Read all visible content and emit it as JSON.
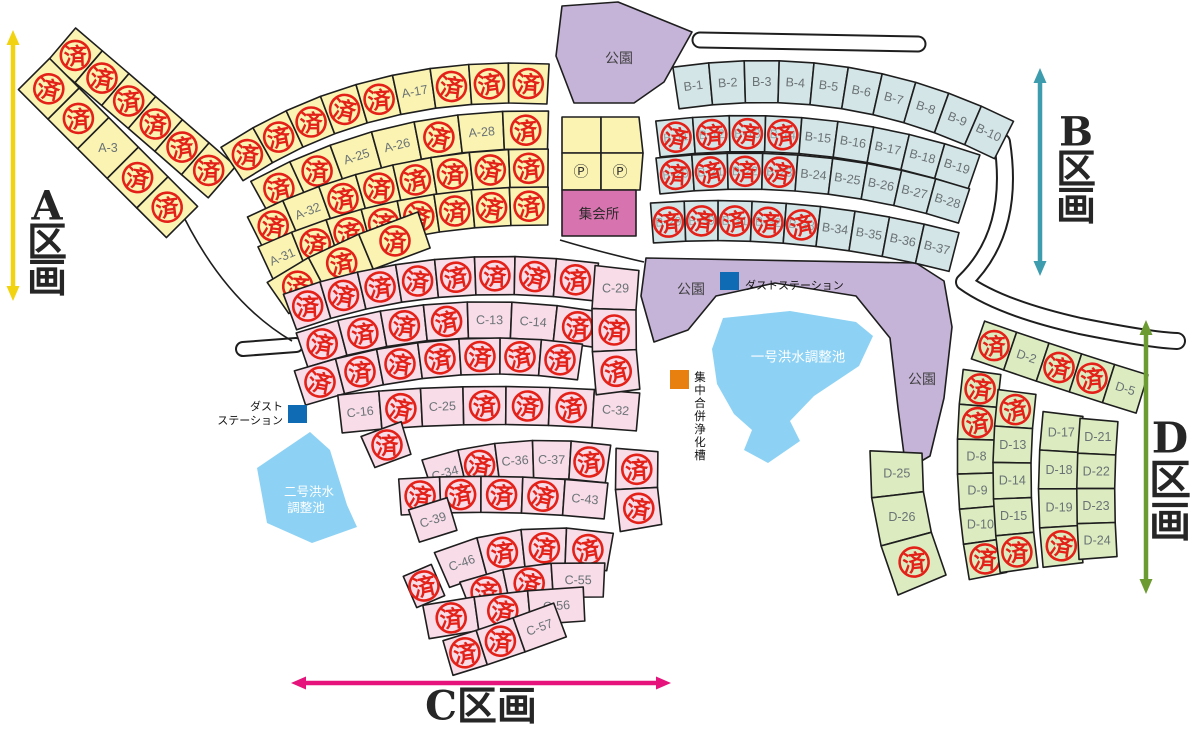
{
  "canvas": {
    "w": 1199,
    "h": 731,
    "bg": "#ffffff",
    "outline": "#1e1e1e"
  },
  "stamp": {
    "char": "済",
    "color": "#e32119",
    "meaning": "sold"
  },
  "lot_label_color": "#6a7275",
  "faint_label_color": "#9aa5a5",
  "sections": [
    {
      "id": "A",
      "label": "A区画",
      "chars": [
        "A",
        "区",
        "画"
      ],
      "arrow_color": "#f2d311",
      "lot_fill": "#faf3b2",
      "arrow": {
        "x1": 13,
        "y1": 30,
        "x2": 13,
        "y2": 301
      },
      "label_x": 47,
      "label_y": 206,
      "label_dy": 36,
      "font": 40,
      "vertical": true
    },
    {
      "id": "B",
      "label": "B区画",
      "chars": [
        "B",
        "区",
        "画"
      ],
      "arrow_color": "#3d9cad",
      "lot_fill": "#d4e5e7",
      "arrow": {
        "x1": 1040,
        "y1": 68,
        "x2": 1040,
        "y2": 276
      },
      "label_x": 1076,
      "label_y": 132,
      "label_dy": 37,
      "font": 40,
      "vertical": true
    },
    {
      "id": "C",
      "label": "C区画",
      "chars": [
        "C",
        "区",
        "画"
      ],
      "arrow_color": "#e5137b",
      "lot_fill": "#f8dce8",
      "arrow": {
        "x1": 291,
        "y1": 683,
        "x2": 671,
        "y2": 683
      },
      "label_x": 481,
      "label_y": 706,
      "font": 40,
      "vertical": false
    },
    {
      "id": "D",
      "label": "D区画",
      "chars": [
        "D",
        "区",
        "画"
      ],
      "arrow_color": "#6c9b31",
      "lot_fill": "#dcecc0",
      "arrow": {
        "x1": 1146,
        "y1": 320,
        "x2": 1146,
        "y2": 594
      },
      "label_x": 1170,
      "label_y": 438,
      "label_dy": 42,
      "font": 42,
      "vertical": true
    }
  ],
  "rows": [
    {
      "sec": "A",
      "p0": [
        62,
        44
      ],
      "c": [
        142,
        112
      ],
      "p2": [
        222,
        182
      ],
      "d": 42,
      "lots": [
        "*",
        "*",
        "*",
        "*",
        "*",
        "*"
      ]
    },
    {
      "sec": "A",
      "p0": [
        34,
        74
      ],
      "c": [
        108,
        148
      ],
      "p2": [
        182,
        222
      ],
      "d": 44,
      "lots": [
        "*",
        "*",
        "A-3",
        "*",
        "*"
      ]
    },
    {
      "sec": "A",
      "p0": [
        232,
        164
      ],
      "c": [
        368,
        74
      ],
      "p2": [
        548,
        84
      ],
      "d": 40,
      "lots": [
        "*",
        "*",
        "*",
        "*",
        "*",
        "A-17",
        "*",
        "*",
        "*"
      ]
    },
    {
      "sec": "A",
      "p0": [
        260,
        198
      ],
      "c": [
        390,
        126
      ],
      "p2": [
        548,
        130
      ],
      "d": 38,
      "lots": [
        "*",
        "*",
        "A-25",
        "A-26",
        "*",
        "A-28",
        "*"
      ]
    },
    {
      "sec": "A",
      "p0": [
        256,
        234
      ],
      "c": [
        392,
        166
      ],
      "p2": [
        548,
        168
      ],
      "d": 38,
      "lots": [
        "*",
        "A-32",
        "*",
        "*",
        "*",
        "*",
        "*",
        "*"
      ]
    },
    {
      "sec": "A",
      "p0": [
        266,
        264
      ],
      "c": [
        395,
        204
      ],
      "p2": [
        548,
        206
      ],
      "d": 38,
      "lots": [
        "A-31",
        "*",
        "*",
        "*",
        "*",
        "*",
        "*",
        "*"
      ]
    },
    {
      "sec": "A",
      "p0": [
        278,
        298
      ],
      "c": [
        330,
        262
      ],
      "p2": [
        424,
        230
      ],
      "d": 38,
      "lots": [
        "*",
        "*",
        "*"
      ]
    },
    {
      "sec": "B",
      "p0": [
        676,
        88
      ],
      "c": [
        850,
        62
      ],
      "p2": [
        1004,
        140
      ],
      "d": 42,
      "lots": [
        "B-1",
        "B-2",
        "B-3",
        "B-4",
        "B-5",
        "B-6",
        "B-7",
        "B-8",
        "B-9",
        "B-10"
      ]
    },
    {
      "sec": "B",
      "p0": [
        658,
        139
      ],
      "c": [
        820,
        119
      ],
      "p2": [
        974,
        172
      ],
      "d": 36,
      "lots": [
        "B-11*",
        "B-12*",
        "B-13*",
        "B-14*",
        "B-15",
        "B-16",
        "B-17",
        "B-18",
        "B-19"
      ]
    },
    {
      "sec": "B",
      "p0": [
        658,
        176
      ],
      "c": [
        816,
        158
      ],
      "p2": [
        964,
        206
      ],
      "d": 36,
      "lots": [
        "B-20*",
        "B-21*",
        "B-22*",
        "B-23*",
        "B-24",
        "B-25",
        "B-26",
        "B-27",
        "B-28"
      ]
    },
    {
      "sec": "B",
      "p0": [
        652,
        223
      ],
      "c": [
        800,
        212
      ],
      "p2": [
        954,
        252
      ],
      "d": 40,
      "lots": [
        "B-29*",
        "B-30*",
        "B-31*",
        "B-32*",
        "B-33*",
        "B-34",
        "B-35",
        "B-36",
        "B-37"
      ]
    },
    {
      "sec": "C",
      "p0": [
        290,
        312
      ],
      "c": [
        430,
        260
      ],
      "p2": [
        596,
        282
      ],
      "d": 38,
      "lots": [
        "*",
        "*",
        "*",
        "*",
        "*",
        "*",
        "*",
        "*"
      ]
    },
    {
      "sec": "C",
      "p0": [
        302,
        350
      ],
      "c": [
        442,
        302
      ],
      "p2": [
        600,
        330
      ],
      "d": 36,
      "lots": [
        "*",
        "*",
        "*",
        "*",
        "C-13",
        "C-14",
        "*"
      ]
    },
    {
      "sec": "C",
      "p0": [
        300,
        388
      ],
      "c": [
        440,
        342
      ],
      "p2": [
        580,
        362
      ],
      "d": 36,
      "lots": [
        "*",
        "*",
        "*",
        "*",
        "*",
        "*",
        "*"
      ]
    },
    {
      "sec": "C",
      "p0": [
        340,
        414
      ],
      "c": [
        480,
        398
      ],
      "p2": [
        638,
        412
      ],
      "d": 38,
      "lots": [
        "C-16",
        "*",
        "C-25",
        "*",
        "*",
        "*",
        "C-32"
      ]
    },
    {
      "sec": "C",
      "p0": [
        617,
        268
      ],
      "c": [
        610,
        330
      ],
      "p2": [
        618,
        392
      ],
      "d": 44,
      "lots": [
        "C-29",
        "*",
        "*"
      ]
    },
    {
      "sec": "C",
      "p0": [
        368,
        452
      ],
      "c": [
        386,
        444
      ],
      "p2": [
        406,
        438
      ],
      "d": 34,
      "lots": [
        "*"
      ]
    },
    {
      "sec": "C",
      "p0": [
        428,
        478
      ],
      "c": [
        512,
        450
      ],
      "p2": [
        608,
        464
      ],
      "d": 38,
      "lots": [
        "C-34",
        "*",
        "C-36",
        "C-37",
        "*"
      ]
    },
    {
      "sec": "C",
      "p0": [
        400,
        497
      ],
      "c": [
        500,
        490
      ],
      "p2": [
        606,
        501
      ],
      "d": 36,
      "lots": [
        "*",
        "*",
        "*",
        "*",
        "C-43"
      ]
    },
    {
      "sec": "C",
      "p0": [
        414,
        526
      ],
      "c": [
        432,
        520
      ],
      "p2": [
        452,
        514
      ],
      "d": 34,
      "lots": [
        "C-39"
      ]
    },
    {
      "sec": "C",
      "p0": [
        637,
        450
      ],
      "c": [
        634,
        488
      ],
      "p2": [
        641,
        528
      ],
      "d": 42,
      "lots": [
        "*",
        "*"
      ]
    },
    {
      "sec": "C",
      "p0": [
        442,
        570
      ],
      "c": [
        520,
        536
      ],
      "p2": [
        610,
        552
      ],
      "d": 38,
      "lots": [
        "C-46",
        "*",
        "*",
        "*"
      ]
    },
    {
      "sec": "C",
      "p0": [
        466,
        598
      ],
      "c": [
        522,
        576
      ],
      "p2": [
        604,
        580
      ],
      "d": 34,
      "lots": [
        "*",
        "*",
        "C-55"
      ]
    },
    {
      "sec": "C",
      "p0": [
        426,
        622
      ],
      "c": [
        500,
        608
      ],
      "p2": [
        584,
        604
      ],
      "d": 34,
      "lots": [
        "*",
        "*",
        "C-56"
      ]
    },
    {
      "sec": "C",
      "p0": [
        448,
        658
      ],
      "c": [
        496,
        644
      ],
      "p2": [
        560,
        620
      ],
      "d": 36,
      "lots": [
        "*",
        "*",
        "C-57"
      ]
    },
    {
      "sec": "C",
      "p0": [
        410,
        592
      ],
      "c": [
        424,
        586
      ],
      "p2": [
        438,
        580
      ],
      "d": 34,
      "lots": [
        "*"
      ]
    },
    {
      "sec": "D",
      "p0": [
        978,
        340
      ],
      "c": [
        1058,
        368
      ],
      "p2": [
        1142,
        394
      ],
      "d": 40,
      "lots": [
        "*",
        "D-2",
        "*",
        "*",
        "D-5"
      ]
    },
    {
      "sec": "D",
      "p0": [
        982,
        372
      ],
      "c": [
        968,
        473
      ],
      "p2": [
        988,
        576
      ],
      "d": 38,
      "lots": [
        "*",
        "*",
        "D-8",
        "D-9",
        "D-10",
        "*"
      ]
    },
    {
      "sec": "D",
      "p0": [
        1017,
        392
      ],
      "c": [
        1006,
        480
      ],
      "p2": [
        1019,
        570
      ],
      "d": 38,
      "lots": [
        "*",
        "D-13",
        "D-14",
        "D-15",
        "*"
      ]
    },
    {
      "sec": "D",
      "p0": [
        1063,
        414
      ],
      "c": [
        1054,
        488
      ],
      "p2": [
        1063,
        565
      ],
      "d": 40,
      "lots": [
        "D-17",
        "D-18",
        "D-19",
        "*"
      ]
    },
    {
      "sec": "D",
      "p0": [
        1099,
        420
      ],
      "c": [
        1093,
        488
      ],
      "p2": [
        1098,
        558
      ],
      "d": 38,
      "lots": [
        "D-21",
        "D-22",
        "D-23",
        "D-24"
      ]
    },
    {
      "sec": "D",
      "p0": [
        896,
        452
      ],
      "c": [
        893,
        515
      ],
      "p2": [
        922,
        585
      ],
      "d": 52,
      "lots": [
        "D-25",
        "D-26",
        "*"
      ]
    }
  ],
  "areas": [
    {
      "name": "park-top",
      "fill": "#c6b4d8",
      "stroke": true,
      "points": [
        [
          562,
          6
        ],
        [
          618,
          2
        ],
        [
          692,
          32
        ],
        [
          664,
          82
        ],
        [
          634,
          103
        ],
        [
          574,
          103
        ],
        [
          556,
          56
        ]
      ],
      "labels": [
        [
          "公園",
          619,
          58
        ]
      ]
    },
    {
      "name": "park-center",
      "fill": "#c6b4d8",
      "stroke": true,
      "points": [
        [
          646,
          258
        ],
        [
          916,
          263
        ],
        [
          944,
          281
        ],
        [
          952,
          327
        ],
        [
          944,
          398
        ],
        [
          930,
          456
        ],
        [
          906,
          470
        ],
        [
          898,
          408
        ],
        [
          890,
          338
        ],
        [
          856,
          296
        ],
        [
          775,
          283
        ],
        [
          716,
          296
        ],
        [
          688,
          330
        ],
        [
          654,
          342
        ],
        [
          641,
          296
        ]
      ],
      "labels": [
        [
          "公園",
          691,
          289
        ],
        [
          "公園",
          922,
          379
        ]
      ]
    },
    {
      "name": "pond-1",
      "fill": "#8dd2f4",
      "stroke": false,
      "points": [
        [
          723,
          318
        ],
        [
          790,
          311
        ],
        [
          856,
          322
        ],
        [
          873,
          336
        ],
        [
          859,
          366
        ],
        [
          814,
          396
        ],
        [
          790,
          421
        ],
        [
          800,
          441
        ],
        [
          768,
          463
        ],
        [
          744,
          450
        ],
        [
          752,
          430
        ],
        [
          734,
          414
        ],
        [
          717,
          384
        ],
        [
          712,
          349
        ]
      ],
      "labels": [
        [
          "一号洪水調整池",
          798,
          357
        ]
      ],
      "label_fill": "#ffffff",
      "label_size": 13.5
    },
    {
      "name": "pond-2",
      "fill": "#8dd2f4",
      "stroke": false,
      "points": [
        [
          310,
          432
        ],
        [
          330,
          450
        ],
        [
          347,
          505
        ],
        [
          357,
          527
        ],
        [
          312,
          543
        ],
        [
          267,
          523
        ],
        [
          257,
          468
        ]
      ],
      "labels": [
        [
          "二号洪水",
          309,
          492
        ],
        [
          "調整池",
          306,
          508
        ]
      ],
      "label_fill": "#ffffff",
      "label_size": 12.5
    },
    {
      "name": "parking-cell-1",
      "fill": "#faf3b2",
      "stroke": true,
      "points": [
        [
          562,
          117
        ],
        [
          601,
          117
        ],
        [
          601,
          153
        ],
        [
          562,
          153
        ]
      ],
      "labels": []
    },
    {
      "name": "parking-cell-2",
      "fill": "#faf3b2",
      "stroke": true,
      "points": [
        [
          601,
          117
        ],
        [
          639,
          117
        ],
        [
          643,
          153
        ],
        [
          601,
          153
        ]
      ],
      "labels": []
    },
    {
      "name": "parking-cell-3",
      "fill": "#faf3b2",
      "stroke": true,
      "points": [
        [
          562,
          153
        ],
        [
          601,
          153
        ],
        [
          601,
          190
        ],
        [
          562,
          190
        ]
      ],
      "labels": [
        [
          "Ⓟ",
          581,
          172
        ]
      ],
      "label_size": 15,
      "label_fill": "#333333"
    },
    {
      "name": "parking-cell-4",
      "fill": "#faf3b2",
      "stroke": true,
      "points": [
        [
          601,
          153
        ],
        [
          643,
          153
        ],
        [
          640,
          190
        ],
        [
          601,
          190
        ]
      ],
      "labels": [
        [
          "Ⓟ",
          620,
          172
        ]
      ],
      "label_size": 15,
      "label_fill": "#333333"
    },
    {
      "name": "meeting-hall",
      "fill": "#d773ae",
      "stroke": true,
      "points": [
        [
          562,
          190
        ],
        [
          636,
          190
        ],
        [
          636,
          236
        ],
        [
          562,
          236
        ]
      ],
      "labels": [
        [
          "集会所",
          599,
          214
        ]
      ],
      "label_size": 13.5,
      "label_fill": "#2a2a2a"
    }
  ],
  "markers": [
    {
      "name": "dust-station-1",
      "color": "#0f6cb4",
      "rect": [
        288,
        405,
        19,
        18
      ],
      "text_lines": [
        "ダスト",
        "ステーション"
      ],
      "text_x": 283,
      "text_y": 407,
      "anchor": "end",
      "line_h": 14
    },
    {
      "name": "dust-station-2",
      "color": "#0f6cb4",
      "rect": [
        720,
        272,
        19,
        18
      ],
      "text_lines": [
        "ダストステーション"
      ],
      "text_x": 745,
      "text_y": 286,
      "anchor": "start",
      "line_h": 14
    },
    {
      "name": "septic-tank",
      "color": "#e8800f",
      "rect": [
        670,
        370,
        19,
        19
      ],
      "vtext": "集中合併浄化槽",
      "vx": 700,
      "vy": 378,
      "char_h": 13
    }
  ],
  "roads": [
    {
      "name": "road-top-culdesac",
      "path": "M 700,40 L 918,44",
      "outer": 17,
      "inner": 13
    },
    {
      "name": "road-b-to-d",
      "path": "M 1002,142 Q 1016,232 964,282 Q 1000,308 1080,326 Q 1150,340 1177,341",
      "outer": 18,
      "inner": 14
    },
    {
      "name": "road-stub-left",
      "path": "M 243,349 L 296,345",
      "outer": 16,
      "inner": 12
    }
  ],
  "edges": [
    {
      "name": "road-edge-a-to-c",
      "path": "M 177,203 Q 222,300 292,341"
    },
    {
      "name": "road-edge-center",
      "path": "M 560,240 Q 600,252 644,262"
    }
  ]
}
